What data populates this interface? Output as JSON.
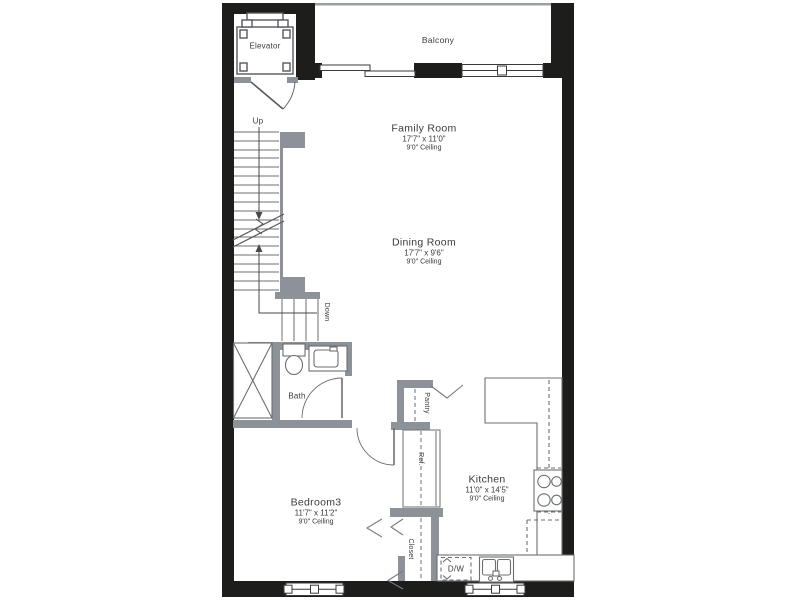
{
  "rooms": {
    "balcony": {
      "label": "Balcony"
    },
    "elevator": {
      "label": "Elevator"
    },
    "family_room": {
      "name": "Family Room",
      "dimensions": "17'7\" x 11'0\"",
      "ceiling": "9'0\" Ceiling"
    },
    "dining_room": {
      "name": "Dining Room",
      "dimensions": "17'7\" x 9'6\"",
      "ceiling": "9'0\" Ceiling"
    },
    "bedroom3": {
      "name": "Bedroom3",
      "dimensions": "11'7\" x 11'2\"",
      "ceiling": "9'0\" Ceiling"
    },
    "kitchen": {
      "name": "Kitchen",
      "dimensions": "11'0\" x 14'5\"",
      "ceiling": "9'0\" Ceiling"
    },
    "bath": {
      "label": "Bath"
    }
  },
  "labels": {
    "up": "Up",
    "down": "Down",
    "pantry": "Pantry",
    "refrigerator": "Ref.",
    "closet": "Closet",
    "dishwasher": "D/W"
  },
  "colors": {
    "exterior_wall": "#1d1d1b",
    "partition_wall": "#8d9298",
    "line": "#555555",
    "text": "#3a3a3a",
    "background": "#ffffff"
  }
}
